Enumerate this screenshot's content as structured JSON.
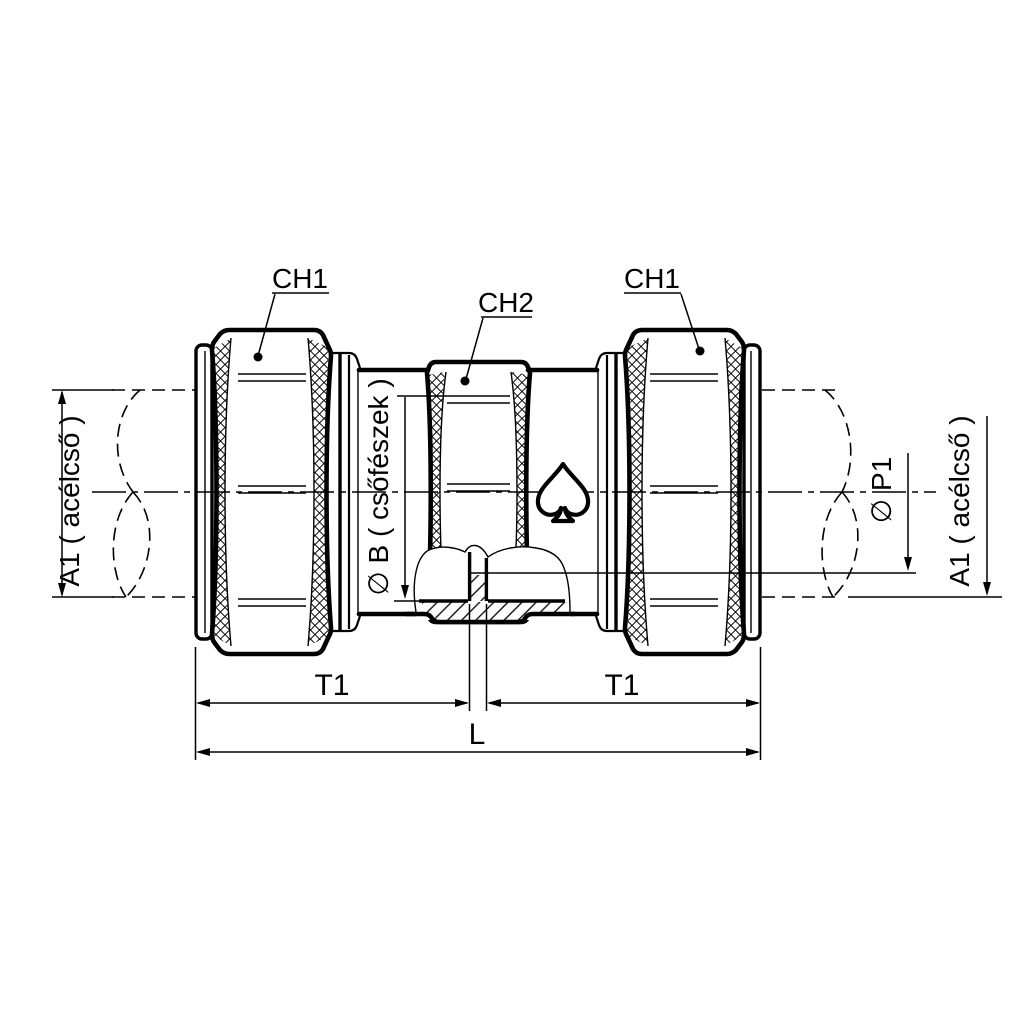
{
  "drawing": {
    "background": "#ffffff",
    "ink": "#000000",
    "part_labels": {
      "ch1_left": "CH1",
      "ch2": "CH2",
      "ch1_right": "CH1"
    },
    "dimension_labels": {
      "a1_left": "A1 ( acélcső )",
      "b_seat": "∅ B ( csőfészek )",
      "p1": "∅ P1",
      "a1_right": "A1 ( acélcső )",
      "t1_left": "T1",
      "t1_right": "T1",
      "overall_length": "L"
    },
    "symbols": {
      "brand": "spade-icon"
    }
  }
}
